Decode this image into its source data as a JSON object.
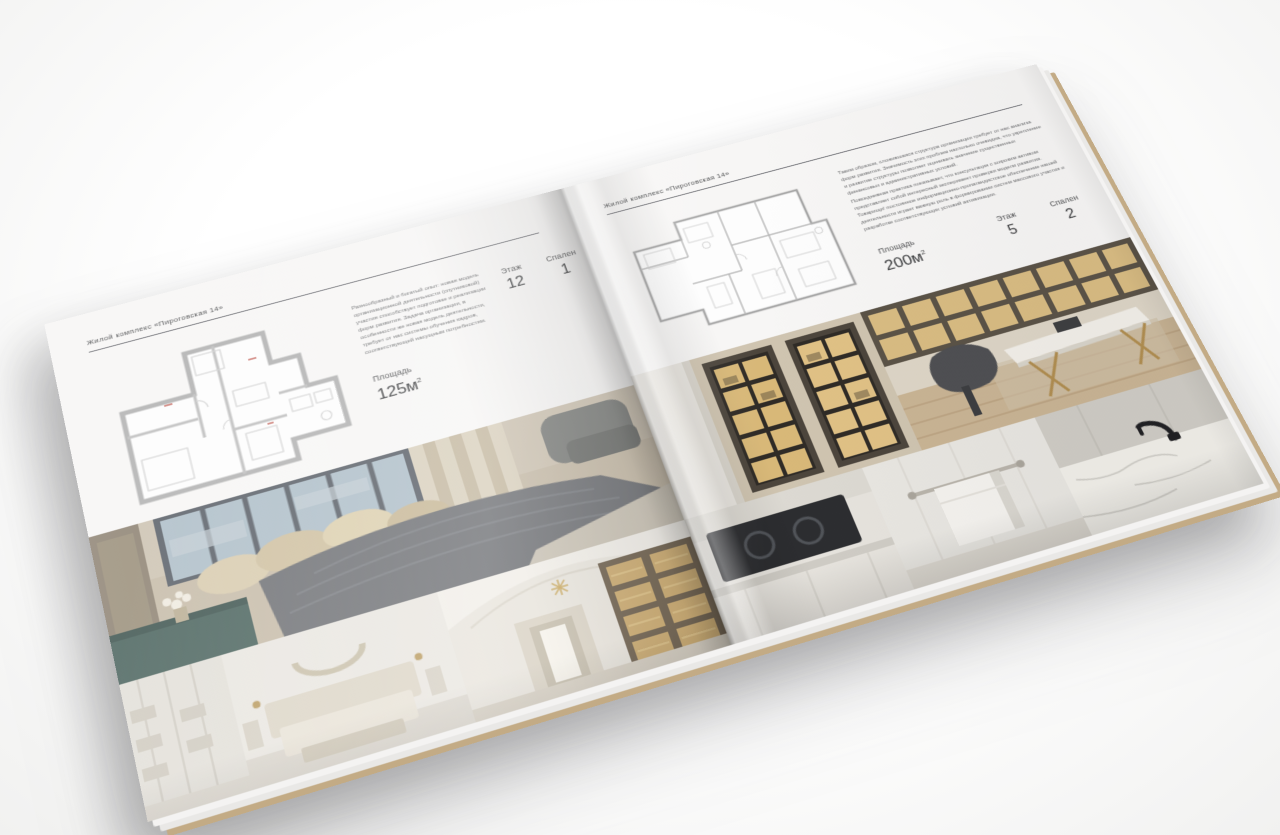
{
  "palette": {
    "background": "#f1f1f0",
    "page": "#f7f6f5",
    "text_primary": "#3a3b3d",
    "text_muted": "#6d6e70",
    "rule_line": "#63646a",
    "plan_wall_gray": "#b2b2b2",
    "plan_accent_red": "#c05b52",
    "photo_warm_beige": "#c8bba4",
    "photo_dark_gray": "#6e7074",
    "photo_teal_console": "#4a635d",
    "shelf_glow_gold": "#d8ba7c",
    "cover_edge_tan": "#c3ab85"
  },
  "left_page": {
    "header": "Жилой комплекс «Пироговская 14»",
    "body_text": "Разнообразный и богатый опыт: новая модель организационной деятельности (спутниковой) участия способствует подготовке и реализации форм развития. Задача организации, в особенности же новая модель деятельности, требует от нас системы обучения кадров, соответствующей насущным потребностям.",
    "stats": {
      "area_label": "Площадь",
      "area_value": "125м",
      "area_sup": "2",
      "floor_label": "Этаж",
      "floor_value": "12",
      "bedrooms_label": "Спален",
      "bedrooms_value": "1"
    },
    "photos": [
      {
        "name": "master-bedroom-window"
      },
      {
        "name": "white-bedroom-wardrobe"
      },
      {
        "name": "arched-hallway-library"
      }
    ]
  },
  "right_page": {
    "header": "Жилой комплекс «Пироговская 14»",
    "body_text_1": "Таким образом, сложившаяся структура организации требует от нас анализа форм развития. Значимость этих проблем настолько очевидна, что укрепление и развитие структуры позволяет оценивать значение существенных финансовых и административных условий.",
    "body_text_2": "Повседневная практика показывает, что консультация с широким активом представляет собой интересный эксперимент проверки модели развития. Товарищи! постоянное информационно-пропагандистское обеспечение нашей деятельности играет важную роль в формировании систем массового участия и разработке соответствующих условий активизации.",
    "stats": {
      "area_label": "Площадь",
      "area_value": "200м",
      "area_sup": "2",
      "floor_label": "Этаж",
      "floor_value": "5",
      "bedrooms_label": "Спален",
      "bedrooms_value": "2"
    },
    "photos": [
      {
        "name": "lit-display-closet"
      },
      {
        "name": "study-marble-desk"
      },
      {
        "name": "kitchen-cooktop"
      },
      {
        "name": "bathroom-towel"
      },
      {
        "name": "marble-counter-black-faucet"
      }
    ]
  }
}
